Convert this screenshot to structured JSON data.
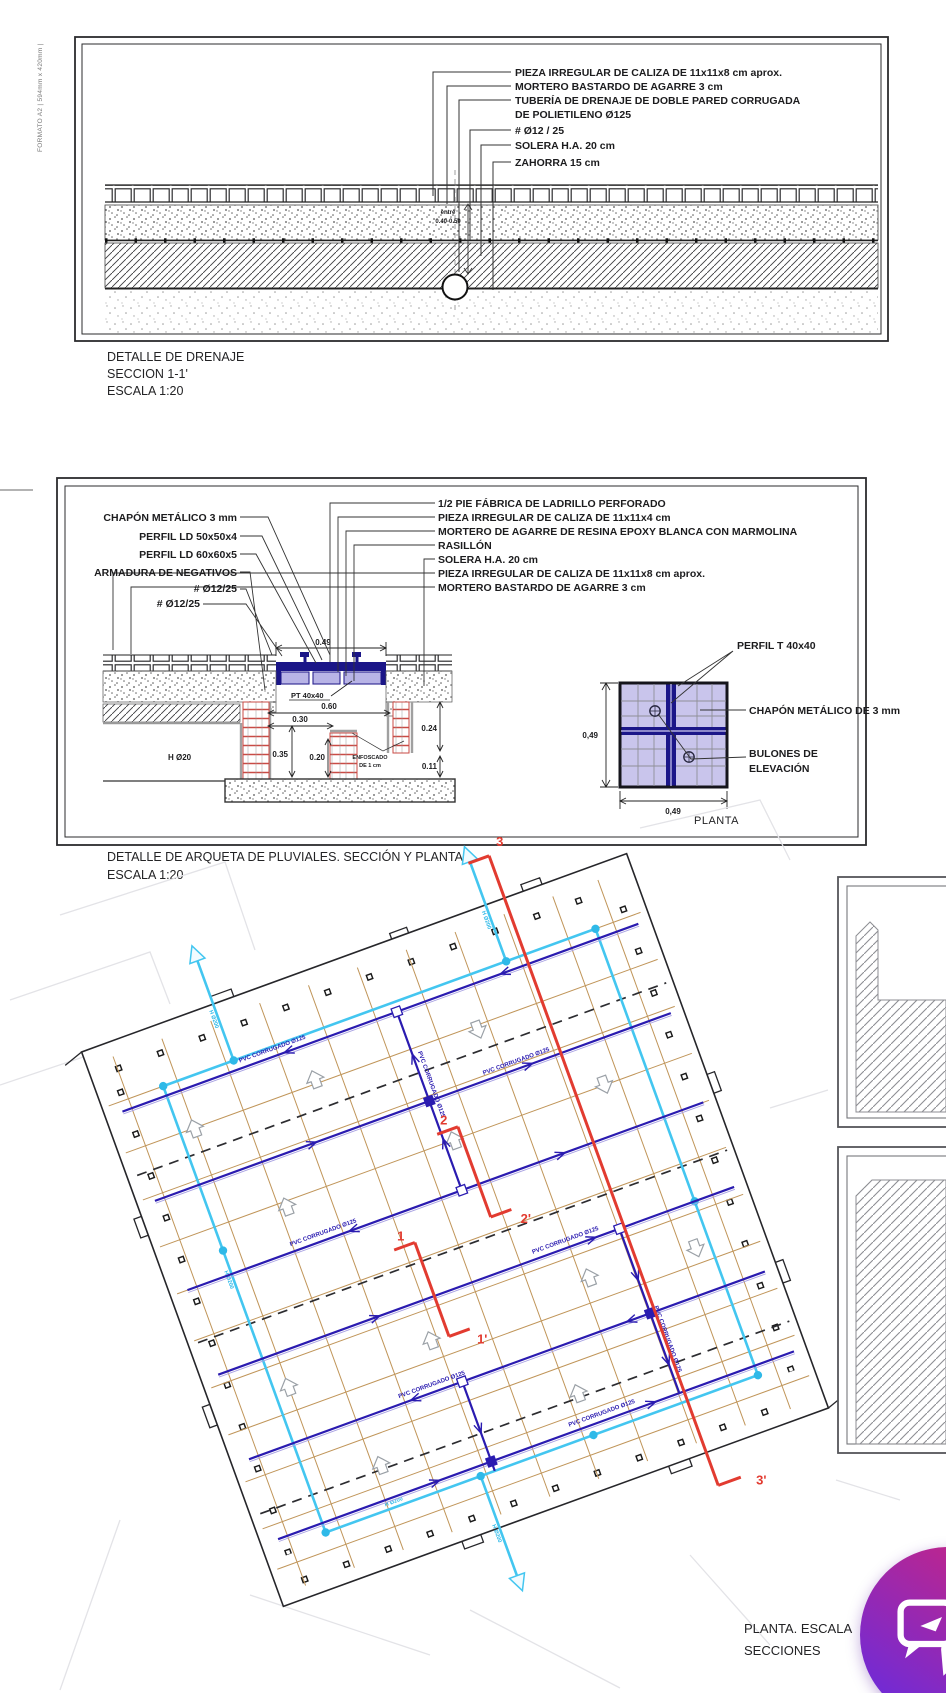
{
  "sheet": {
    "format": "FORMATO A2 | 594mm x 420mm |"
  },
  "drawing1": {
    "callouts": [
      "PIEZA IRREGULAR DE CALIZA DE 11x11x8 cm aprox.",
      "MORTERO BASTARDO DE AGARRE 3 cm",
      "TUBERÍA DE DRENAJE DE DOBLE PARED CORRUGADA",
      "DE POLIETILENO Ø125",
      "# Ø12 / 25",
      "SOLERA H.A. 20 cm",
      "ZAHORRA 15 cm"
    ],
    "dim": {
      "line1": "entre",
      "line2": "0.40-0.50"
    },
    "title": [
      "DETALLE DE DRENAJE",
      "SECCION 1-1'",
      "ESCALA 1:20"
    ]
  },
  "drawing2": {
    "left_labels": [
      "CHAPÓN METÁLICO 3 mm",
      "PERFIL LD 50x50x4",
      "PERFIL LD 60x60x5",
      "ARMADURA DE NEGATIVOS",
      "# Ø12/25",
      "# Ø12/25"
    ],
    "right_labels": [
      "1/2 PIE FÁBRICA DE LADRILLO PERFORADO",
      "PIEZA IRREGULAR DE CALIZA DE 11x11x4 cm",
      "MORTERO DE AGARRE DE RESINA EPOXY BLANCA CON MARMOLINA",
      "RASILLÓN",
      "SOLERA H.A. 20 cm",
      "PIEZA IRREGULAR DE CALIZA DE 11x11x8 cm aprox.",
      "MORTERO BASTARDO DE AGARRE 3 cm"
    ],
    "dims": {
      "top": "0.49",
      "pt": "PT 40x40",
      "w060": "0.60",
      "w030": "0.30",
      "h035": "0.35",
      "h020": "0.20",
      "h024": "0.24",
      "h011": "0.11",
      "hd20": "H Ø20",
      "enf1": "ENFOSCADO",
      "enf2": "DE 1 cm"
    },
    "planta": {
      "side": "0,49",
      "bottom": "0,49",
      "perfil": "PERFIL T 40x40",
      "chapon": "CHAPÓN METÁLICO DE 3 mm",
      "bulones1": "BULONES DE",
      "bulones2": "ELEVACIÓN",
      "caption": "PLANTA"
    },
    "title": [
      "DETALLE DE ARQUETA DE PLUVIALES. SECCIÓN Y PLANTA.",
      "ESCALA 1:20"
    ]
  },
  "plan": {
    "markers": {
      "m3": "3",
      "m3p": "3'",
      "m2": "2",
      "m2p": "2'",
      "m1": "1",
      "m1p": "1'"
    },
    "labels": {
      "pvc": "PVC CORRUGADO Ø125",
      "h200": "H Ø200"
    },
    "caption": [
      "PLANTA. ESCALA",
      "SECCIONES"
    ]
  },
  "colors": {
    "pipe_navy": "#2a1bb0",
    "pipe_cyan": "#43c6f0",
    "section_red": "#e23b30",
    "grid_tan": "#c09559",
    "cover_navy": "#1b1688",
    "cover_lavender": "#b8b4e6",
    "brick_red": "#c94b45",
    "fab_from": "#c62585",
    "fab_to": "#6d2bd9"
  }
}
